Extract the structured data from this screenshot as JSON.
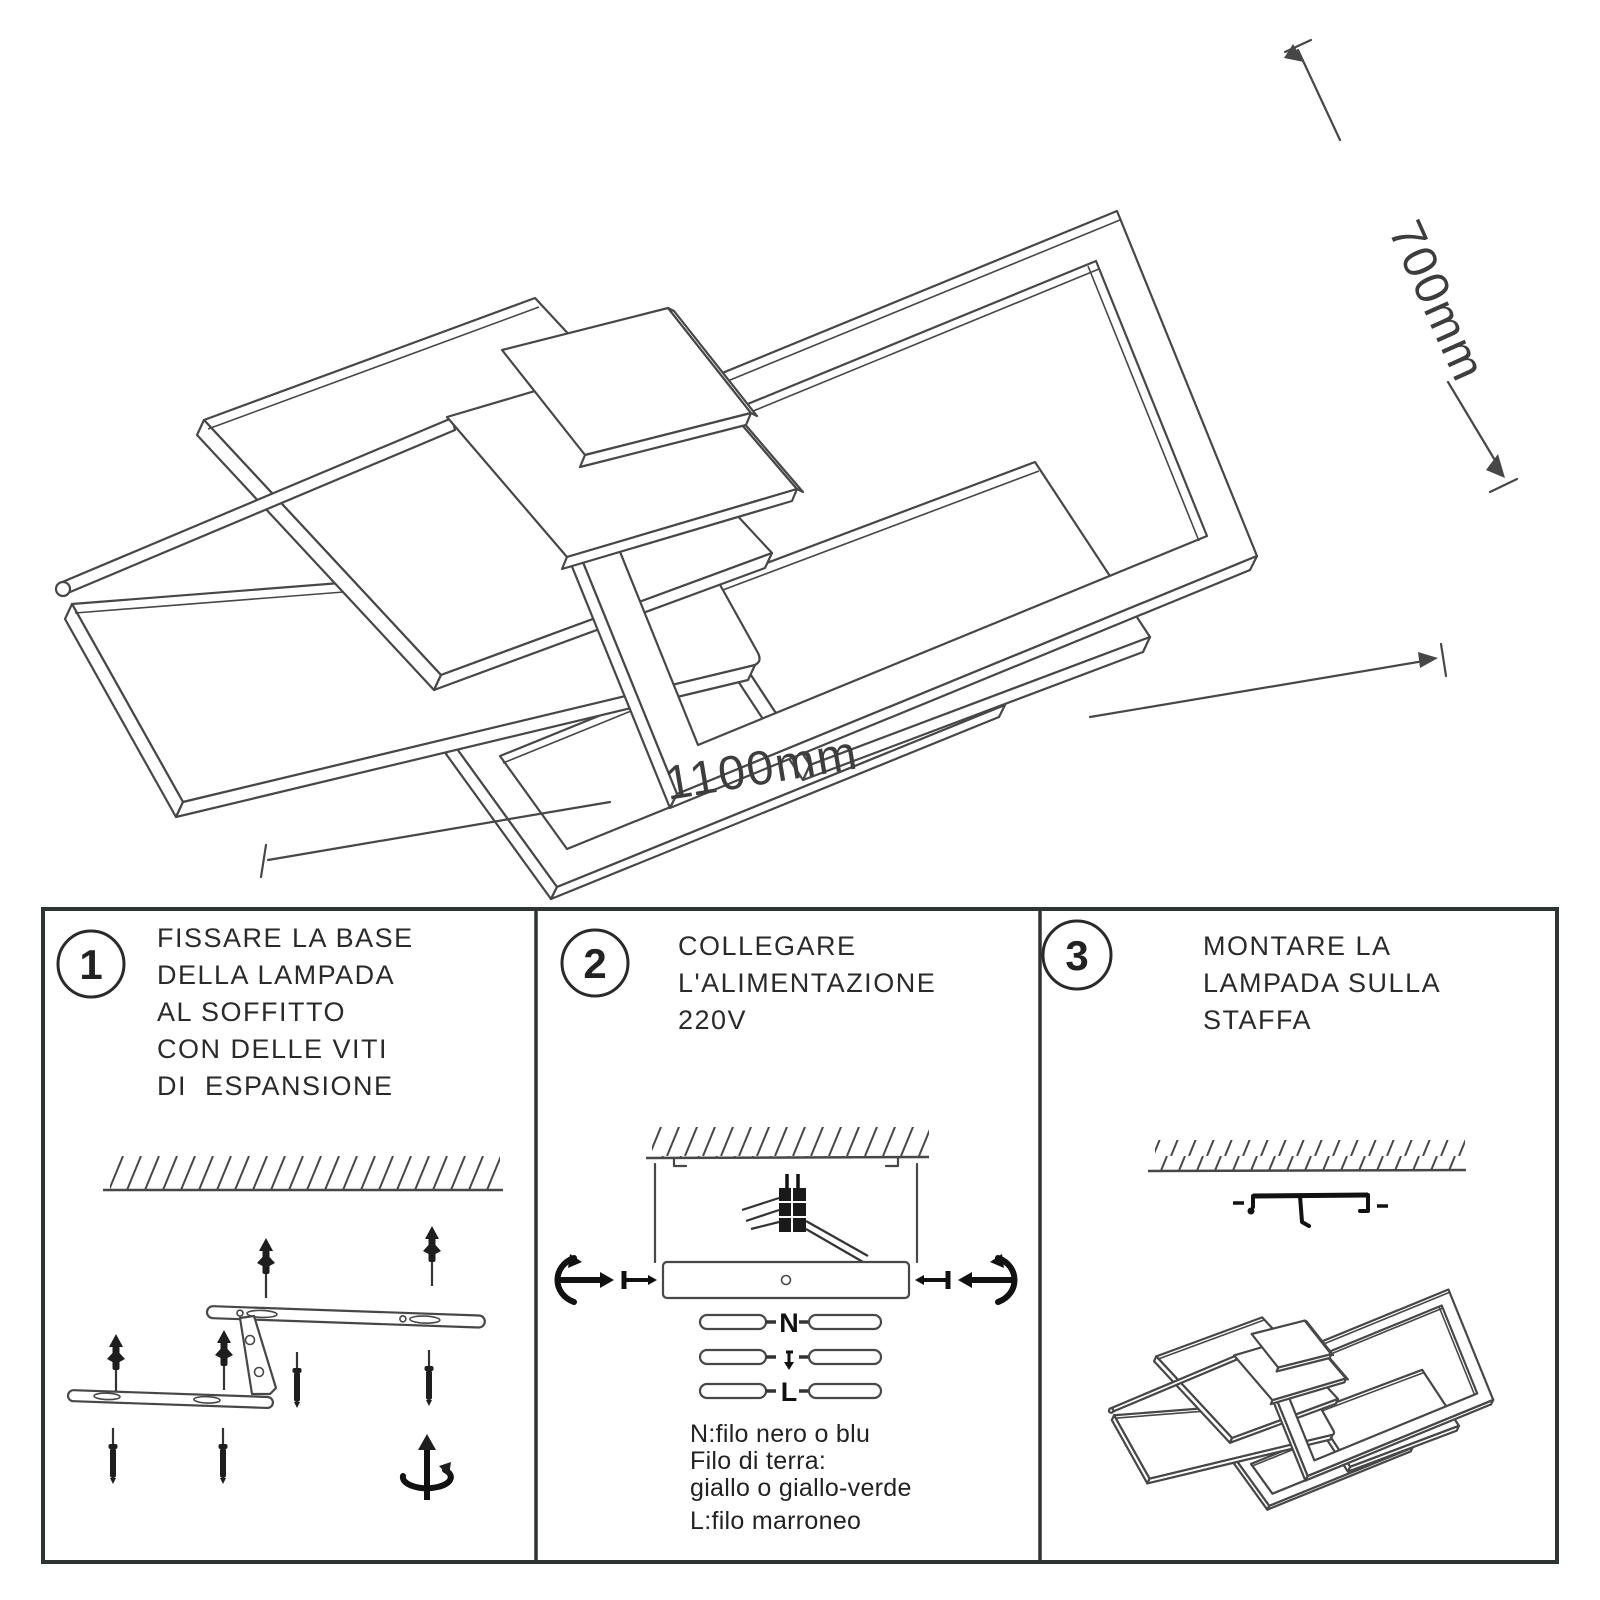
{
  "drawing": {
    "width_label": "1100mm",
    "height_label": "700mm"
  },
  "steps": [
    {
      "number": "1",
      "lines": [
        "FISSARE LA BASE",
        "DELLA LAMPADA",
        "AL SOFFITTO",
        "CON DELLE VITI",
        "DI  ESPANSIONE"
      ]
    },
    {
      "number": "2",
      "lines": [
        "COLLEGARE",
        "L'ALIMENTAZIONE",
        "220V"
      ],
      "terminals": [
        "N",
        "L"
      ],
      "notes": [
        "N:filo nero o blu",
        "Filo di terra:",
        "giallo o giallo-verde",
        "L:filo marroneo"
      ]
    },
    {
      "number": "3",
      "lines": [
        "MONTARE LA",
        "LAMPADA SULLA",
        "STAFFA"
      ]
    }
  ],
  "icons": [
    "ceiling-hatch",
    "expansion-anchor",
    "screw",
    "rotation-arrow",
    "screw-in-arrow",
    "earth-symbol",
    "mounting-bracket",
    "wire-connector"
  ],
  "colors": {
    "line": "#474747",
    "ink": "#2a2a2a",
    "border": "#2e3531",
    "dark": "#1e1e1e"
  }
}
